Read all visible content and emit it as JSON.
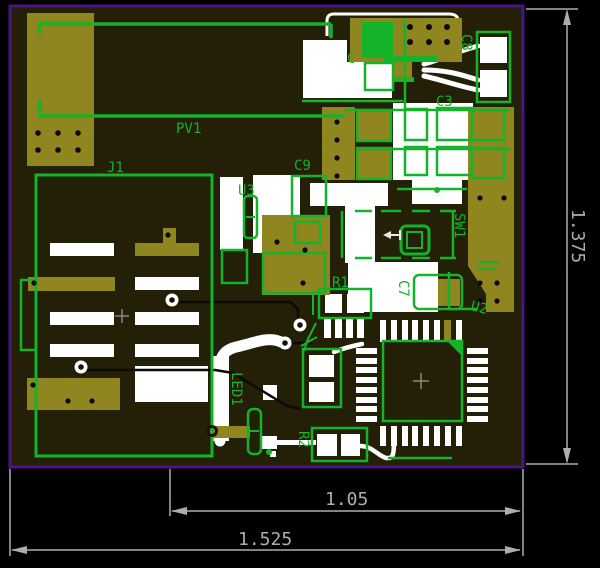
{
  "app": {
    "type": "pcb-layout-editor",
    "view": "board-top"
  },
  "colors": {
    "background": "#000000",
    "board_outline": "#4a1580",
    "substrate": "#241f07",
    "copper": "#908620",
    "silkscreen": "#ffffff",
    "component_green": "#14b32a",
    "dimension_gray": "#a7b0af",
    "hole_black": "#0a0903"
  },
  "labels": {
    "pv1": "PV1",
    "j1": "J1",
    "u3": "U3",
    "c9": "C9",
    "c1": "C",
    "c8": "C8",
    "c3": "C3",
    "sw1": "SW1",
    "r1": "R1",
    "c7": "C7",
    "u2": "U2",
    "led1": "LED1",
    "r2": "R2"
  },
  "dimensions": {
    "board_width": "1.525",
    "inner_width": "1.05",
    "board_height": "1.375"
  }
}
